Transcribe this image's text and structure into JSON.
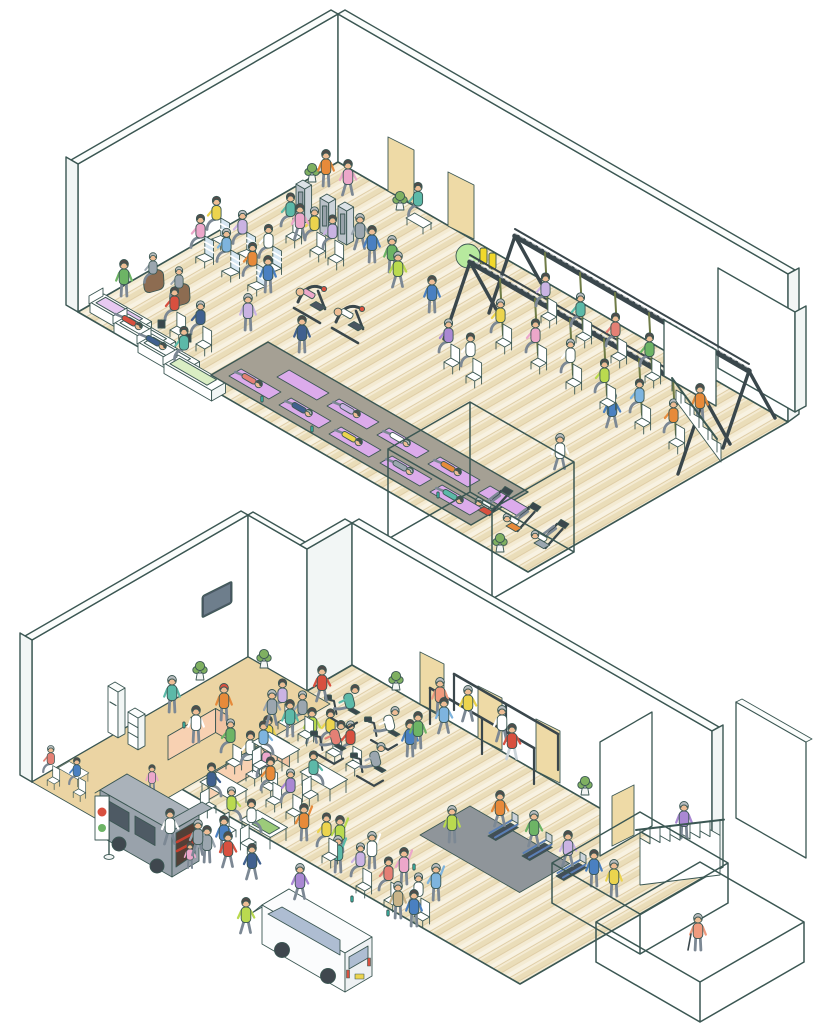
{
  "scene": {
    "illustration_type": "isometric cutaway line illustration",
    "setting": "two-floor community fitness and wellness center",
    "background": "#ffffff",
    "floors": [
      {
        "id": "upper-floor",
        "position": "top half",
        "features": [
          "massage-recovery-beds",
          "reclining-relax-stations",
          "brown-massage-chairs",
          "weight-stack-machines",
          "strength-machines",
          "gray-stretch-strip-with-purple-yoga-mats",
          "suspension-training-truss-rig-with-chairs",
          "leg-press-machines-in-cutaway-cube",
          "exercise-ball-and-foam-rollers",
          "two-tan-doors",
          "descending-staircase-with-railing",
          "potted-plants",
          "bench-by-door"
        ],
        "approx_people": 58
      },
      {
        "id": "lower-floor",
        "position": "bottom half",
        "features": [
          "kitchen-cafe-corner-with-counters-and-fridge",
          "wall-tv",
          "activity-tables",
          "group-stretching-seated-and-standing",
          "recumbent-exercise-bikes",
          "walking-parallel-bars",
          "treadmill-platform",
          "three-tan-doors",
          "ascending-staircase-with-railing",
          "cutaway-outline-cubes",
          "person-with-cane",
          "gray-food-truck-with-banner",
          "white-minivan",
          "entrance-plaza-with-walking-people"
        ],
        "approx_people": 60
      }
    ]
  },
  "palette": {
    "line": "#3b5753",
    "wall": "#ffffff",
    "wallside": "#f2f6f5",
    "band": "#fbfdfc",
    "wood1": "#f4ebd3",
    "wood2": "#eaddb9",
    "wood3": "#f8f2e2",
    "woodline": "#dcc89f",
    "kitchen": "#ebd4a3",
    "door": "#eedaa6",
    "matarea": "#a5a094",
    "yogamat": "#dcabeb",
    "bedlav": "#e7c9f1",
    "bedgreen": "#daeec4",
    "counter": "#f8d1b2",
    "counterside": "#f0c3a2",
    "steel": "#3a474c",
    "strap": "#6f7c46",
    "ball": "#b7e99e",
    "roller": "#f1d82b",
    "towerc": "#ccd3d9",
    "towerside": "#b9c1c8",
    "towertop": "#dde3e7",
    "skin": "#eebd95",
    "hair": "#514c4a",
    "hairgray": "#b9bdbf",
    "pants": "#7c8894",
    "pantslight": "#ccd5da",
    "bottle": "#36b9a7",
    "plant": "#7fb061",
    "pot": "#f3f5f4",
    "tv": "#4c5a66",
    "tvscreen": "#6e7e8c",
    "truck": "#aab2ba",
    "truckside": "#99a2ab",
    "truckdark": "#4e5a64",
    "truckint": "#533f36",
    "truckred": "#c5402f",
    "van": "#fbfcfd",
    "vanside": "#eef1f3",
    "glassw": "#aebdd2",
    "tread": "#5a7fb5",
    "treadbase": "#8f959a",
    "deck": "#434e57",
    "stripe": "#d7e7f2",
    "table_mat": "#9ccb7a",
    "brown_chair": "#8d6c51",
    "c_red": "#d8503f",
    "c_orange": "#e78a3a",
    "c_yellow": "#ecd44e",
    "c_lime": "#bada4f",
    "c_green": "#6db465",
    "c_teal": "#5cb9a8",
    "c_blue": "#4a80c1",
    "c_sky": "#7eb4de",
    "c_navy": "#40608f",
    "c_pink": "#eca7ca",
    "c_rose": "#e48075",
    "c_purple": "#aa88d3",
    "c_lav": "#cab3e3",
    "c_white": "#ffffff",
    "c_gray": "#9ba6af",
    "c_salmon": "#f09b7e",
    "c_khaki": "#c9b489",
    "c_brown": "#9b7959"
  }
}
